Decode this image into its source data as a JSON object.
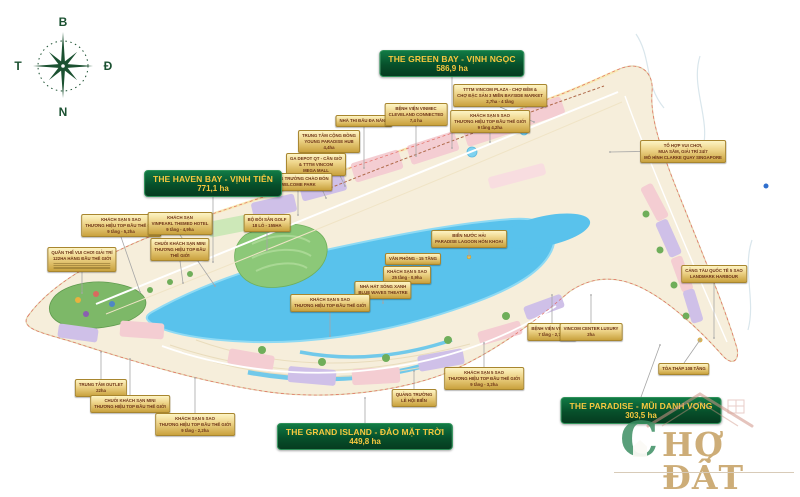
{
  "compass": {
    "north": "B",
    "east": "Đ",
    "south": "N",
    "west": "T"
  },
  "zones": [
    {
      "id": "the-green-bay",
      "name": "THE GREEN BAY - VỊNH NGỌC",
      "area": "586,9 ha",
      "cx": 452,
      "y": 50,
      "dir": "down",
      "tx": 452,
      "ty": 148
    },
    {
      "id": "the-haven-bay",
      "name": "THE HAVEN BAY - VỊNH TIÊN",
      "area": "771,1 ha",
      "cx": 213,
      "y": 170,
      "dir": "down",
      "tx": 213,
      "ty": 262
    },
    {
      "id": "the-grand-island",
      "name": "THE GRAND ISLAND - ĐẢO MẶT TRỜI",
      "area": "449,8 ha",
      "cx": 365,
      "y": 423,
      "dir": "up",
      "tx": 365,
      "ty": 398
    },
    {
      "id": "the-paradise",
      "name": "THE PARADISE - MŨI DANH VỌNG",
      "area": "303,5 ha",
      "cx": 641,
      "y": 397,
      "dir": "up",
      "tx": 660,
      "ty": 345
    }
  ],
  "callouts": [
    {
      "id": "nha-thi-dau-da-nang",
      "cx": 364,
      "y": 115,
      "dir": "down",
      "ty": 168,
      "lines": [
        "NHÀ THI ĐẤU ĐA NĂNG"
      ]
    },
    {
      "id": "benh-vien-vinmec-cleveland",
      "cx": 416,
      "y": 103,
      "dir": "down",
      "ty": 156,
      "lines": [
        "BỆNH VIỆN VINMEC",
        "CLEVELAND CONNECTED",
        "7,4 ha"
      ]
    },
    {
      "id": "tttm-vincom-plaza",
      "cx": 500,
      "y": 84,
      "dir": "down",
      "tx": 534,
      "ty": 122,
      "lines": [
        "TTTM VINCOM PLAZA - CHỢ ĐÊM &",
        "CHỢ ĐẶC SẢN 3 MIỀN BAYSIDE MARKET",
        "2,7ha - 4 tầng"
      ]
    },
    {
      "id": "khach-san-5-sao-42",
      "cx": 490,
      "y": 110,
      "dir": "down",
      "ty": 142,
      "lines": [
        "KHÁCH SẠN 5 SAO",
        "THƯƠNG HIỆU TOP ĐẦU THẾ GIỚI",
        "9 tầng 4,2ha"
      ]
    },
    {
      "id": "trung-tam-cong-dong-hub",
      "cx": 329,
      "y": 130,
      "dir": "down",
      "tx": 345,
      "ty": 186,
      "lines": [
        "TRUNG TÂM CỘNG ĐỒNG",
        "YOUNG PARADISE HUB",
        "4,4ha"
      ]
    },
    {
      "id": "ga-depot-can-gio",
      "cx": 316,
      "y": 153,
      "dir": "down",
      "tx": 326,
      "ty": 198,
      "lines": [
        "GA DEPOT QT - CẦN GIỜ",
        "& TTTM VINCOM",
        "MEGA MALL"
      ]
    },
    {
      "id": "quang-truong-chao-don",
      "cx": 298,
      "y": 173,
      "dir": "down",
      "ty": 215,
      "lines": [
        "QUẢNG TRƯỜNG CHÀO ĐÓN",
        "WELCOME PARK"
      ]
    },
    {
      "id": "to-hop-clarke-quay",
      "cx": 683,
      "y": 140,
      "dir": "left",
      "tx": 610,
      "ty": 152,
      "lines": [
        "TỔ HỢP VUI CHƠI,",
        "MUA SẮM, GIẢI TRÍ 24/7",
        "MÔ HÌNH CLARKE QUAY SINGAPORE"
      ]
    },
    {
      "id": "khach-san-5-sao-52",
      "cx": 121,
      "y": 214,
      "dir": "down",
      "tx": 140,
      "ty": 292,
      "lines": [
        "KHÁCH SẠN 5 SAO",
        "THƯƠNG HIỆU TOP ĐẦU THẾ GIỚI",
        "9 tầng - 5,2ha"
      ]
    },
    {
      "id": "khach-san-vinpearl",
      "cx": 180,
      "y": 212,
      "dir": "down",
      "tx": 215,
      "ty": 286,
      "lines": [
        "KHÁCH SẠN",
        "VINPEARL THEMED HOTEL",
        "9 tầng - 4,9ha"
      ]
    },
    {
      "id": "quan-the-vui-choi-122ha",
      "cx": 82,
      "y": 247,
      "dir": "down",
      "ty": 293,
      "fineprint": 3,
      "lines": [
        "QUẦN THỂ VUI CHƠI GIẢI TRÍ",
        "122HA HÀNG ĐẦU THẾ GIỚI"
      ]
    },
    {
      "id": "chuoi-khach-san-mini-1",
      "cx": 180,
      "y": 238,
      "dir": "down",
      "tx": 183,
      "ty": 283,
      "lines": [
        "CHUỖI KHÁCH SẠN MINI",
        "THƯƠNG HIỆU TOP ĐẦU",
        "THẾ GIỚI"
      ]
    },
    {
      "id": "bo-doi-san-golf",
      "cx": 267,
      "y": 214,
      "dir": "down",
      "ty": 250,
      "lines": [
        "BỘ ĐÔI SÂN GOLF",
        "18 LỖ - 155HA"
      ]
    },
    {
      "id": "van-phong-15-tang",
      "cx": 413,
      "y": 253,
      "dir": "down",
      "ty": 268,
      "lines": [
        "VĂN PHÒNG - 15 TẦNG"
      ]
    },
    {
      "id": "khach-san-25-tang",
      "cx": 407,
      "y": 266,
      "dir": "down",
      "ty": 287,
      "lines": [
        "KHÁCH SẠN 5 SAO",
        "25 tầng - 0,9ha"
      ]
    },
    {
      "id": "nha-hat-song-xanh",
      "cx": 383,
      "y": 281,
      "dir": "down",
      "ty": 303,
      "lines": [
        "NHÀ HÁT SÓNG XANH",
        "BLUE WAVES THEATRE"
      ]
    },
    {
      "id": "bien-nuoc-hai-lagoon",
      "cx": 469,
      "y": 230,
      "dir": "down",
      "ty": 256,
      "lines": [
        "BIỂN NƯỚC HẢI",
        "PARADISE LAGOON HÒN KHOAI"
      ]
    },
    {
      "id": "khach-san-5-sao-mid",
      "cx": 330,
      "y": 294,
      "dir": "down",
      "ty": 336,
      "lines": [
        "KHÁCH SẠN 5 SAO",
        "THƯƠNG HIỆU TOP ĐẦU THẾ GIỚI"
      ]
    },
    {
      "id": "quang-truong-le-hoi-bien",
      "cx": 414,
      "y": 389,
      "dir": "up",
      "ty": 371,
      "lines": [
        "QUẢNG TRƯỜNG",
        "LỄ HỘI BIỂN"
      ]
    },
    {
      "id": "khach-san-5-sao-32",
      "cx": 484,
      "y": 367,
      "dir": "up",
      "ty": 343,
      "lines": [
        "KHÁCH SẠN 5 SAO",
        "THƯƠNG HIỆU TOP ĐẦU THẾ GIỚI",
        "9 tầng - 3,2ha"
      ]
    },
    {
      "id": "benh-vien-vinmec",
      "cx": 552,
      "y": 323,
      "dir": "up",
      "ty": 295,
      "lines": [
        "BỆNH VIỆN VINMEC",
        "7 tầng - 2,7ha"
      ]
    },
    {
      "id": "vincom-center-luxury",
      "cx": 591,
      "y": 323,
      "dir": "up",
      "ty": 295,
      "lines": [
        "VINCOM CENTER LUXURY",
        "2ha"
      ]
    },
    {
      "id": "cang-tau-quoc-te",
      "cx": 714,
      "y": 265,
      "dir": "down",
      "ty": 338,
      "lines": [
        "CẢNG TÀU QUỐC TẾ 5 SAO",
        "LANDMARK HARBOUR"
      ]
    },
    {
      "id": "toa-thap-108-tang",
      "cx": 684,
      "y": 363,
      "dir": "up",
      "tx": 700,
      "ty": 340,
      "lines": [
        "TÒA THÁP 108 TẦNG"
      ]
    },
    {
      "id": "trung-tam-outlet",
      "cx": 101,
      "y": 379,
      "dir": "up",
      "ty": 352,
      "lines": [
        "TRUNG TÂM OUTLET",
        "22ha"
      ]
    },
    {
      "id": "chuoi-khach-san-mini-2",
      "cx": 130,
      "y": 395,
      "dir": "up",
      "ty": 359,
      "lines": [
        "CHUỖI KHÁCH SẠN MINI",
        "THƯƠNG HIỆU TOP ĐẦU THẾ GIỚI"
      ]
    },
    {
      "id": "khach-san-5-sao-22",
      "cx": 195,
      "y": 413,
      "dir": "up",
      "ty": 378,
      "lines": [
        "KHÁCH SẠN 5 SAO",
        "THƯƠNG HIỆU TOP ĐẦU THẾ GIỚI",
        "9 tầng - 2,2ha"
      ]
    }
  ],
  "watermark": {
    "initial": "C",
    "rest": "HỢ ĐẤT"
  },
  "colors": {
    "zone_box_top": "#117a45",
    "zone_box_bottom": "#063b20",
    "zone_border": "#2f9159",
    "zone_text": "#f7c83f",
    "callout_top": "#fdf4c4",
    "callout_bottom": "#c9a23e",
    "callout_border": "#a8862f",
    "callout_text": "#6e3418",
    "leader": "#a6a6a6",
    "land": "#f6eedb",
    "lagoon": "#59c2ec",
    "compass": "#1b5131",
    "boundary": "#e05a50",
    "watermark_green": "#3d8f63",
    "watermark_gold": "#c8a56a"
  }
}
